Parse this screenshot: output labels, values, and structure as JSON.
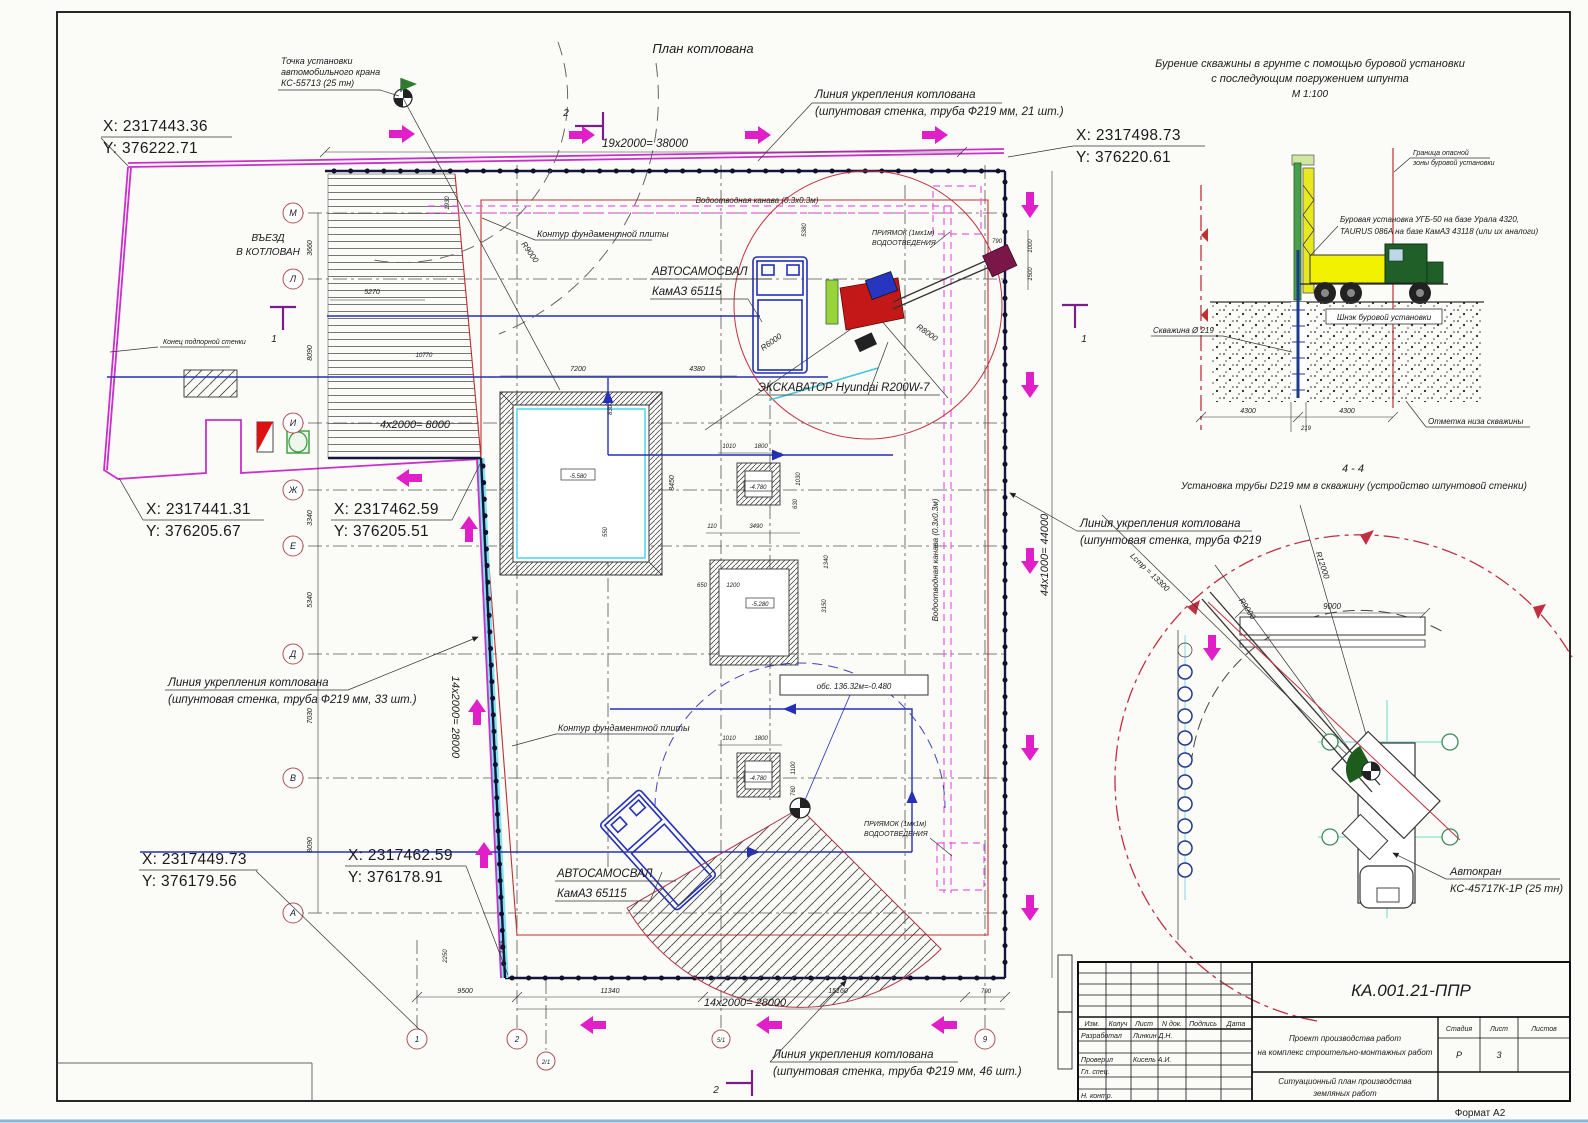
{
  "sheet": {
    "format": "Формат А2"
  },
  "plan": {
    "title": "План котлована",
    "crane_point": [
      "Точка установки",
      "автомобильного крана",
      "КС-55713 (25 тн)"
    ],
    "coords": {
      "top_left_x": "X: 2317443.36",
      "top_left_y": "Y: 376222.71",
      "top_right_x": "X: 2317498.73",
      "top_right_y": "Y: 376220.61",
      "mid_left_x": "X: 2317441.31",
      "mid_left_y": "Y: 376205.67",
      "mid_x": "X: 2317462.59",
      "mid_y": "Y: 376205.51",
      "bottom_left_x": "X: 2317449.73",
      "bottom_left_y": "Y: 376179.56",
      "bottom_mid_x": "X: 2317462.59",
      "bottom_mid_y": "Y: 376178.91"
    },
    "dims": {
      "top": "19х2000= 38000",
      "entry": "4х2000= 8000",
      "left_v": "14х2000= 28000",
      "right_v": "44х1000= 44000",
      "bottom": "14х2000= 28000",
      "bottom_row": [
        "9500",
        "11340",
        "15160",
        "790"
      ],
      "left_col": [
        "3660",
        "8090",
        "3340",
        "5340",
        "7030",
        "8090"
      ],
      "misc": [
        "5270",
        "10770",
        "1930",
        "5380",
        "7200",
        "4380",
        "8450",
        "830",
        "550",
        "1010",
        "1800",
        "1030",
        "630",
        "110",
        "3490",
        "1340",
        "3150",
        "650",
        "1200",
        "1100",
        "760",
        "790",
        "1000",
        "1500",
        "2250",
        "1405"
      ]
    },
    "labels": {
      "entrance": [
        "ВЪЕЗД",
        "В КОТЛОВАН"
      ],
      "wall_end": "Конец подпорной стенки",
      "reinf_top": [
        "Линия укрепления котлована",
        "(шпунтовая стенка, труба Ф219 мм, 21 шт.)"
      ],
      "reinf_left": [
        "Линия укрепления котлована",
        "(шпунтовая стенка, труба Ф219 мм, 33 шт.)"
      ],
      "reinf_bottom": [
        "Линия укрепления котлована",
        "(шпунтовая стенка, труба Ф219 мм, 46 шт.)"
      ],
      "reinf_right": [
        "Линия укрепления котлована",
        "(шпунтовая стенка, труба Ф219"
      ],
      "foundation": "Контур фундаментной плиты",
      "canal": "Водоотводная канава (0.3х0.3м)",
      "sump1": "ПРИЯМОК (1мх1м)",
      "sump2": "ВОДООТВЕДЕНИЯ",
      "truck1": "АВТОСАМОСВАЛ",
      "truck2": "КамАЗ 65115",
      "excavator": "ЭКСКАВАТОР Hyundai R200W-7",
      "elev_note": "обс. 136.32м=-0.480",
      "elev_pit1": "-5.580",
      "elev_pit2": "-4.780",
      "elev_pit3": "-5.280",
      "r8000": "R8000",
      "r6000": "R6000",
      "r9000": "R9000"
    },
    "axes_left": [
      "М",
      "Л",
      "И",
      "Ж",
      "Е",
      "Д",
      "В",
      "А"
    ],
    "axes_bottom": [
      "1",
      "2",
      "2/1",
      "5/1",
      "9"
    ],
    "section_markers": [
      "1",
      "2"
    ]
  },
  "drilling": {
    "title1": "Бурение скважины в грунте с помощью буровой установки",
    "title2": "с последующим погружением шпунта",
    "scale": "М 1:100",
    "danger1": "Граница опасной",
    "danger2": "зоны буровой установки",
    "rig1": "Буровая установка УГБ-50 на базе Урала 4320,",
    "rig2": "TAURUS 086A на базе КамАЗ 43118 (или их аналоги)",
    "auger": "Шнэк буровой установки",
    "borehole": "Скважина Ø 219",
    "bottom_mark": "Отметка низа скважины",
    "dim_left": "4300",
    "dim_right": "4300",
    "dim_hole": "219"
  },
  "section44": {
    "num": "4 - 4",
    "title": "Установка трубы D219 мм в скважину (устройство шпунтовой стенки)",
    "crane1": "Автокран",
    "crane2": "КС-45717К-1Р (25 тн)",
    "beam_dim": "9000",
    "r12000": "R12000",
    "r9000": "R9000",
    "boom_len": "Lстр = 13300"
  },
  "title_block": {
    "doc": "КА.001.21-ППР",
    "headers": [
      "Изм.",
      "Колуч",
      "Лист",
      "N док.",
      "Подпись",
      "Дата"
    ],
    "role1": "Разработал",
    "name1": "Линкин Д.Н.",
    "role2": "Проверил",
    "name2": "Кисель А.И.",
    "role3": "Гл. спец.",
    "role4": "Н. контр.",
    "project1": "Проект производства работ",
    "project2": "на комплекс строительно-монтажных работ",
    "doc_title1": "Ситуационный план производства",
    "doc_title2": "земляных работ",
    "stage_h": [
      "Стадия",
      "Лист",
      "Листов"
    ],
    "stage_v": [
      "Р",
      "3"
    ]
  }
}
